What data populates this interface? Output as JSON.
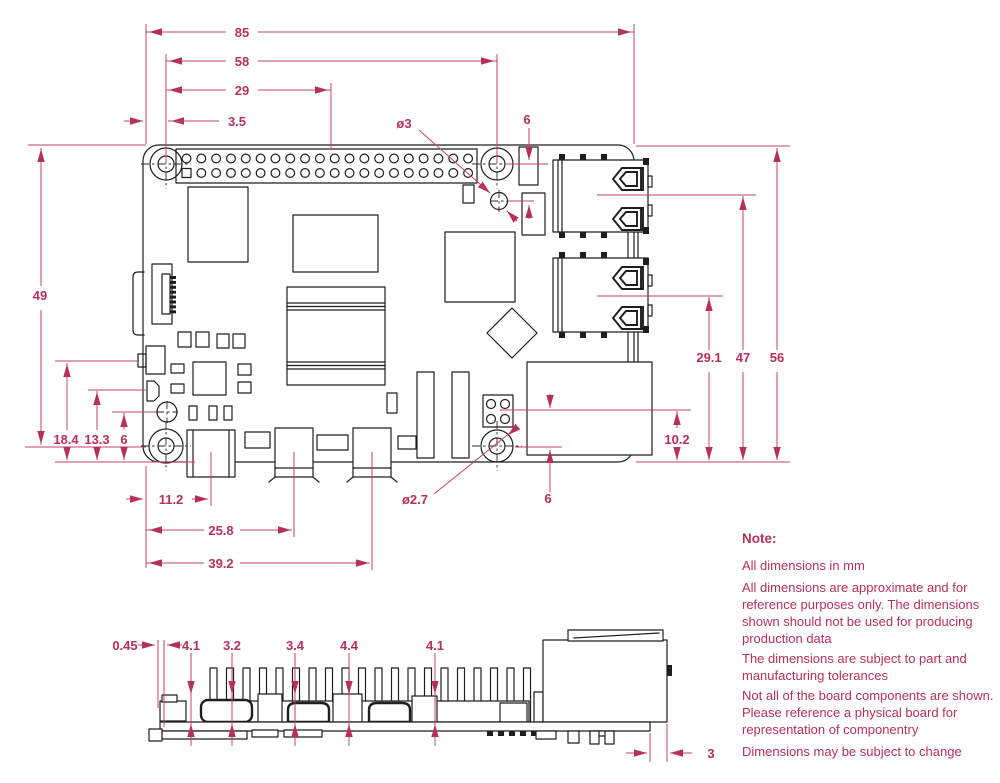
{
  "colors": {
    "dimension": "#b5305a",
    "drawing": "#1e1e1e",
    "background": "#ffffff"
  },
  "dims": {
    "top": {
      "board_width": "85",
      "hole_pitch_x": "58",
      "gpio_center": "29",
      "edge_to_hole": "3.5",
      "hole_diameter": "ø3",
      "hole_offset": "6"
    },
    "right": {
      "board_height": "56",
      "usb_upper_center": "47",
      "usb_lower_center": "29.1",
      "eth_center": "10.2"
    },
    "left": {
      "hole_pitch_y": "49",
      "comp_a_center": "18.4",
      "comp_b_center": "13.3",
      "hole_offset": "6"
    },
    "bottom": {
      "usbc_center": "11.2",
      "hdmi0_center": "25.8",
      "hdmi1_center": "39.2",
      "hole_diameter": "ø2.7",
      "poe_offset": "6"
    },
    "side": {
      "offset_a": "0.45",
      "height_b": "4.1",
      "height_c": "3.2",
      "height_d": "3.4",
      "height_e": "4.4",
      "height_f": "4.1",
      "eth_overhang": "3"
    }
  },
  "notes": {
    "heading": "Note:",
    "paragraphs": [
      [
        "All dimensions in mm"
      ],
      [
        "All dimensions are approximate and for",
        "reference purposes only. The dimensions",
        "shown should not be used for producing",
        "production data"
      ],
      [
        "The dimensions are subject to part and",
        "manufacturing tolerances"
      ],
      [
        "Not all of the board components are shown.",
        "Please reference a physical board for",
        "representation of componentry"
      ],
      [
        "Dimensions may be subject to change"
      ]
    ]
  }
}
